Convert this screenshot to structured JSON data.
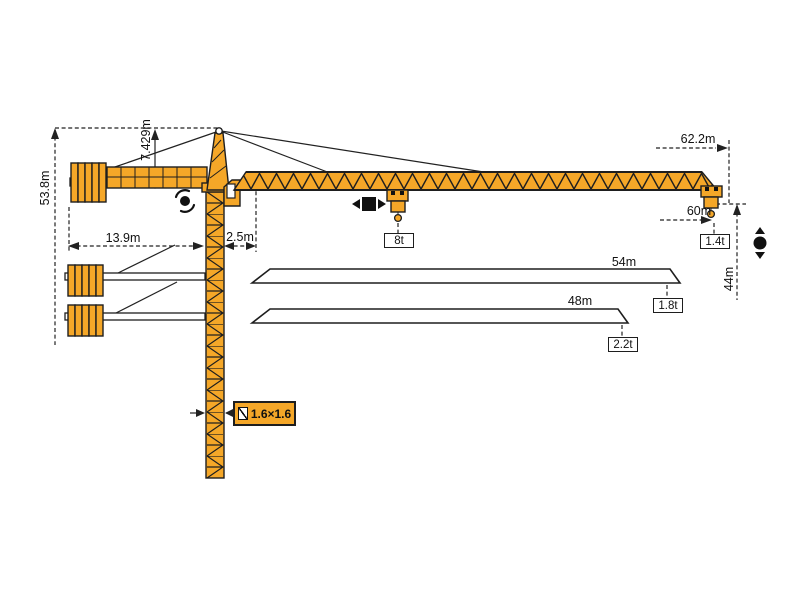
{
  "diagram": {
    "dimensions": {
      "overall_height": "53.8m",
      "tower_head_height": "7.429m",
      "counter_jib_radius": "13.9m",
      "jib_root_offset": "2.5m",
      "max_radius": "62.2m",
      "working_radius": "60m",
      "hook_height": "44m",
      "mast_cross_section": "1.6×1.6"
    },
    "loads": {
      "max_capacity": "8t",
      "tip_load_max_radius": "1.4t"
    },
    "jib_variants": [
      {
        "length": "54m",
        "tip_load": "1.8t"
      },
      {
        "length": "48m",
        "tip_load": "2.2t"
      }
    ],
    "icons": {
      "slewing": "slewing-rotation",
      "trolley": "trolley-travel",
      "hoist": "hoist-up-down",
      "section": "mast-cross-section"
    },
    "colors": {
      "crane_orange": "#F5A728",
      "outline_black": "#1E1E1E"
    }
  }
}
